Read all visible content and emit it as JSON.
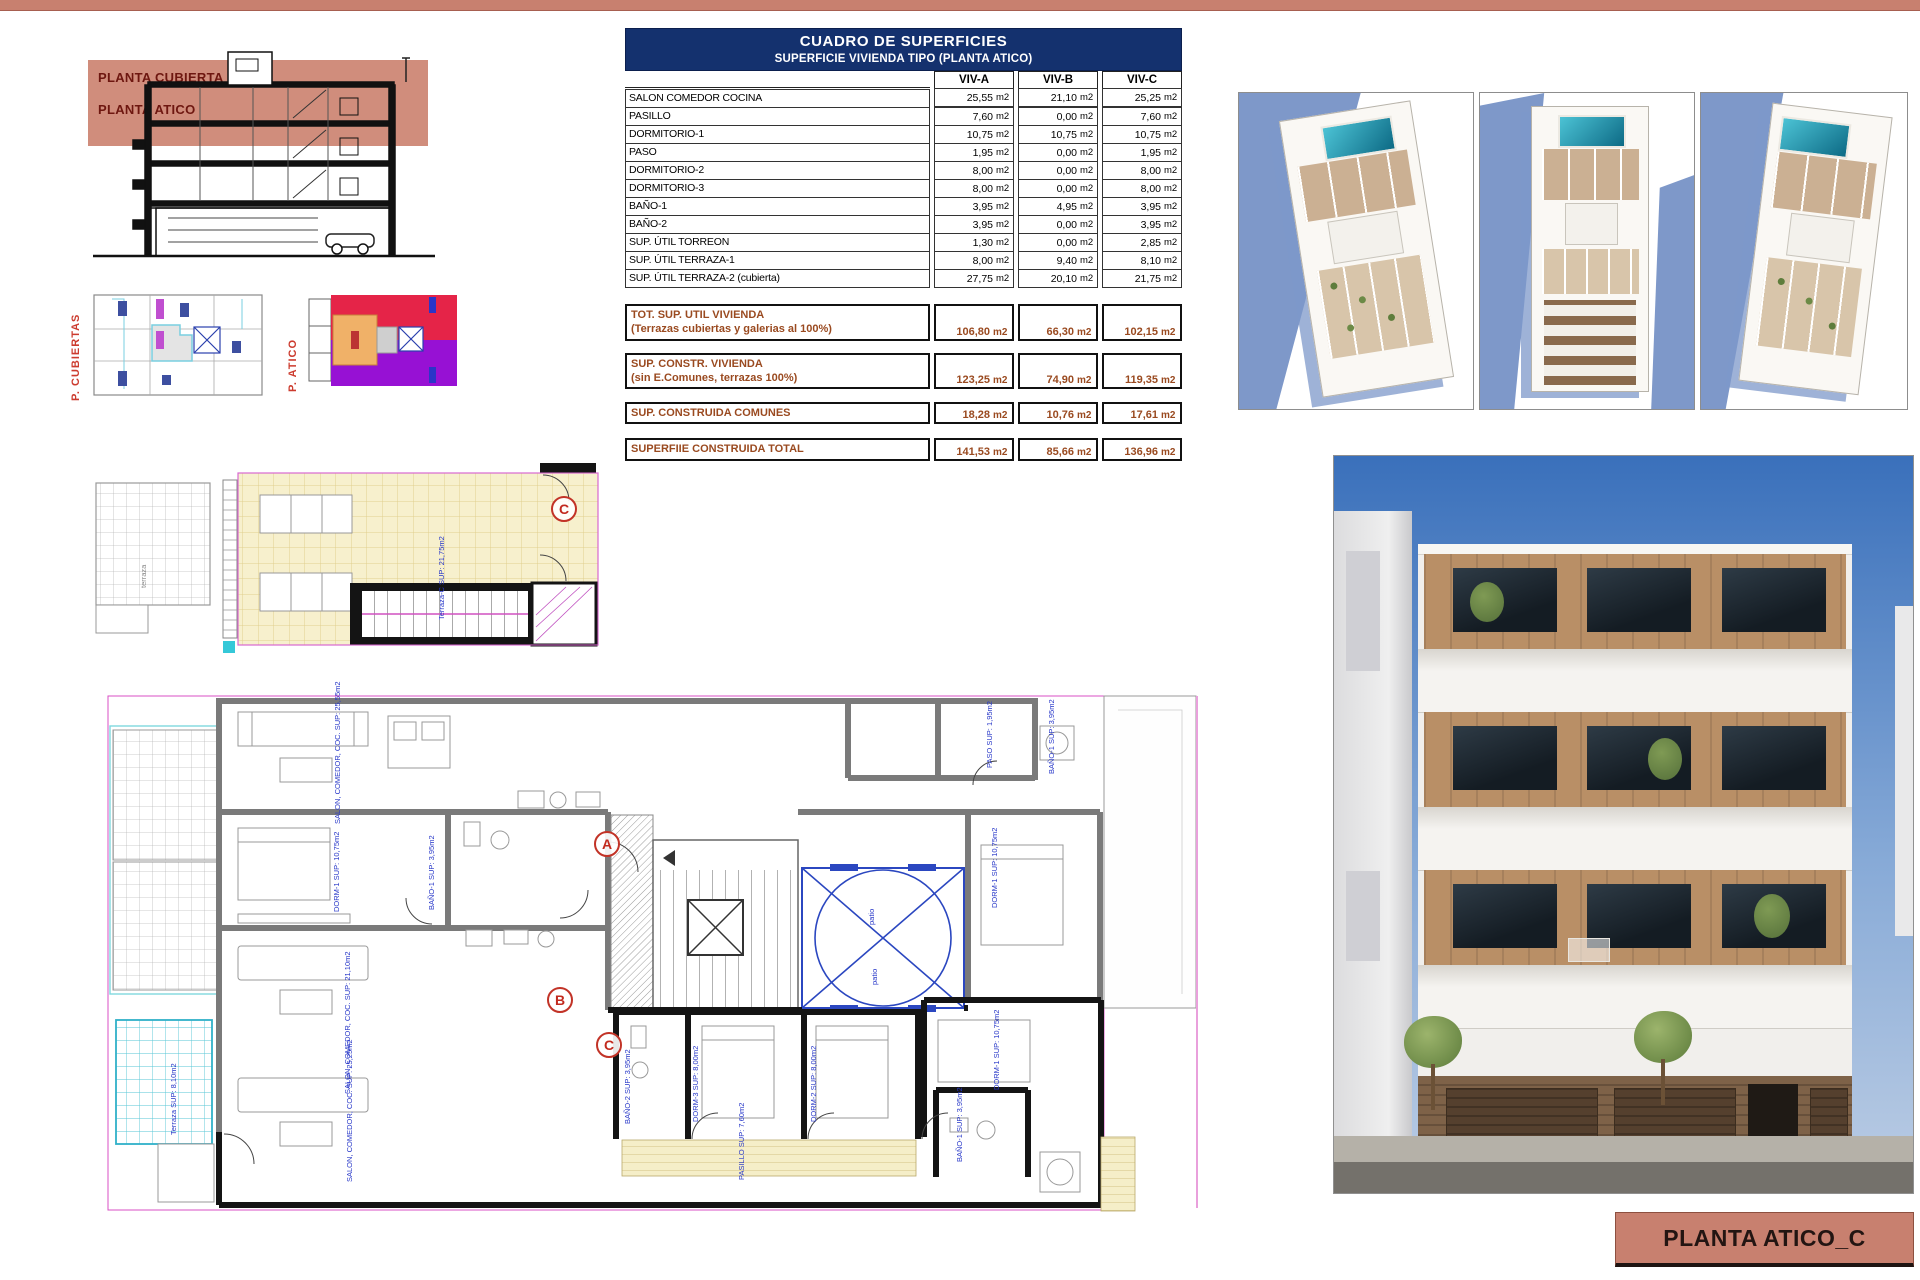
{
  "page": {
    "top_strip_color": "#c8806f",
    "background": "#ffffff"
  },
  "colors": {
    "salmon": "#c8806f",
    "navy_header": "#14316e",
    "totals_brown": "#9a4a20",
    "marker_red": "#c23327",
    "plan_label_blue": "#2636c8",
    "pool_teal": "#2aa9c0",
    "atico_red": "#e52448",
    "atico_purple": "#9711d4",
    "atico_orange": "#f0b168",
    "terrace_yellow": "#f7f0cd",
    "terrace_cyan": "#55c6d6",
    "shadow_blue": "#7e98c9"
  },
  "section_drawing": {
    "band_labels": [
      "PLANTA CUBIERTA",
      "PLANTA ATICO"
    ]
  },
  "key_plans": {
    "cubiertas_label": "P. CUBIERTAS",
    "atico_label": "P. ATICO"
  },
  "surface_table": {
    "title": "CUADRO DE SUPERFICIES",
    "subtitle": "SUPERFICIE VIVIENDA TIPO  (PLANTA ATICO)",
    "unit": "m2",
    "columns": [
      "VIV-A",
      "VIV-B",
      "VIV-C"
    ],
    "rows": [
      {
        "label": "SALON COMEDOR COCINA",
        "values": [
          "25,55",
          "21,10",
          "25,25"
        ]
      },
      {
        "label": "PASILLO",
        "values": [
          "7,60",
          "0,00",
          "7,60"
        ]
      },
      {
        "label": "DORMITORIO-1",
        "values": [
          "10,75",
          "10,75",
          "10,75"
        ]
      },
      {
        "label": "PASO",
        "values": [
          "1,95",
          "0,00",
          "1,95"
        ]
      },
      {
        "label": "DORMITORIO-2",
        "values": [
          "8,00",
          "0,00",
          "8,00"
        ]
      },
      {
        "label": "DORMITORIO-3",
        "values": [
          "8,00",
          "0,00",
          "8,00"
        ]
      },
      {
        "label": "BAÑO-1",
        "values": [
          "3,95",
          "4,95",
          "3,95"
        ]
      },
      {
        "label": "BAÑO-2",
        "values": [
          "3,95",
          "0,00",
          "3,95"
        ]
      },
      {
        "label": "SUP. ÚTIL TORREON",
        "values": [
          "1,30",
          "0,00",
          "2,85"
        ]
      },
      {
        "label": "SUP. ÚTIL TERRAZA-1",
        "values": [
          "8,00",
          "9,40",
          "8,10"
        ]
      },
      {
        "label": "SUP. ÚTIL TERRAZA-2 (cubierta)",
        "values": [
          "27,75",
          "20,10",
          "21,75"
        ]
      }
    ],
    "totals": [
      {
        "label": "TOT. SUP. UTIL VIVIENDA",
        "sublabel": "(Terrazas cubiertas y galerias al 100%)",
        "values": [
          "106,80",
          "66,30",
          "102,15"
        ]
      },
      {
        "label": "SUP. CONSTR. VIVIENDA",
        "sublabel": "(sin E.Comunes, terrazas 100%)",
        "values": [
          "123,25",
          "74,90",
          "119,35"
        ]
      },
      {
        "label": "SUP. CONSTRUIDA COMUNES",
        "sublabel": "",
        "values": [
          "18,28",
          "10,76",
          "17,61"
        ]
      },
      {
        "label": "SUPERFIIE CONSTRUIDA TOTAL",
        "sublabel": "",
        "values": [
          "141,53",
          "85,66",
          "136,96"
        ]
      }
    ]
  },
  "floor_plan": {
    "upper_marker": "C",
    "markers": [
      "A",
      "B",
      "C"
    ],
    "upper_labels": [
      {
        "text": "Terraza-C  SUP: 21,75m2"
      },
      {
        "text": "terraza"
      }
    ],
    "labels": [
      {
        "text": "SALON, COMEDOR, COC.  SUP: 25,55m2"
      },
      {
        "text": "DORM-1  SUP: 10,75m2"
      },
      {
        "text": "BAÑO-1  SUP: 3,95m2"
      },
      {
        "text": "PASO  SUP: 1,95m2"
      },
      {
        "text": "BAÑO-1  SUP: 3,95m2"
      },
      {
        "text": "DORM-1  SUP: 10,75m2"
      },
      {
        "text": "patio"
      },
      {
        "text": "patio"
      },
      {
        "text": "SALON, COMEDOR, COC.  SUP: 21,10m2"
      },
      {
        "text": "SALON, COMEDOR, COC.  SUP: 25,25m2"
      },
      {
        "text": "BAÑO-2  SUP: 3,95m2"
      },
      {
        "text": "DORM-3  SUP: 8,00m2"
      },
      {
        "text": "DORM-2  SUP: 8,00m2"
      },
      {
        "text": "BAÑO-1  SUP: 3,95m2"
      },
      {
        "text": "PASILLO  SUP: 7,60m2"
      },
      {
        "text": "DORM-1  SUP: 10,75m2"
      },
      {
        "text": "Terraza  SUP: 8,10m2"
      }
    ]
  },
  "title_block": {
    "label": "PLANTA ATICO_C"
  }
}
